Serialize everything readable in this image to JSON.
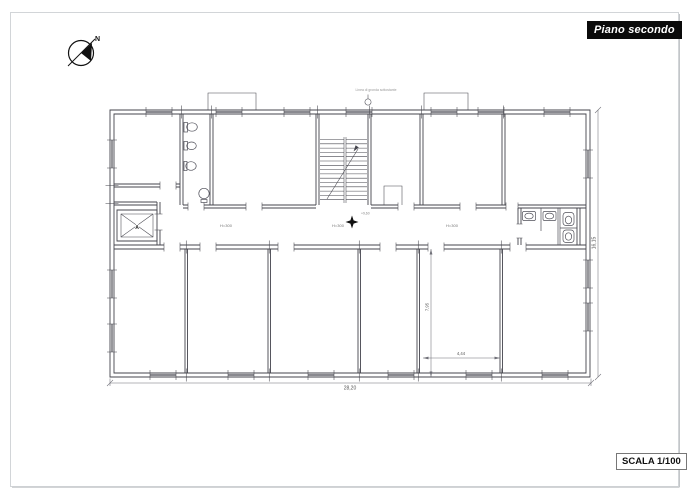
{
  "page": {
    "title_badge": "Piano secondo",
    "scale_badge": "SCALA 1/100",
    "north_label": "N"
  },
  "plan": {
    "roof_note": "Linea di gronda sottostante",
    "level_marker": "+9,60",
    "corridor_height_labels": [
      "H=300",
      "H=300",
      "H=300"
    ],
    "elevator_label": "A",
    "dimensions": {
      "overall_width": "28,20",
      "overall_height": "16,15",
      "room_depth": "7,95",
      "room_width": "4,44"
    },
    "colors": {
      "line": "#45454d",
      "dim_text": "#555555",
      "badge_bg": "#0a0a0a"
    }
  }
}
